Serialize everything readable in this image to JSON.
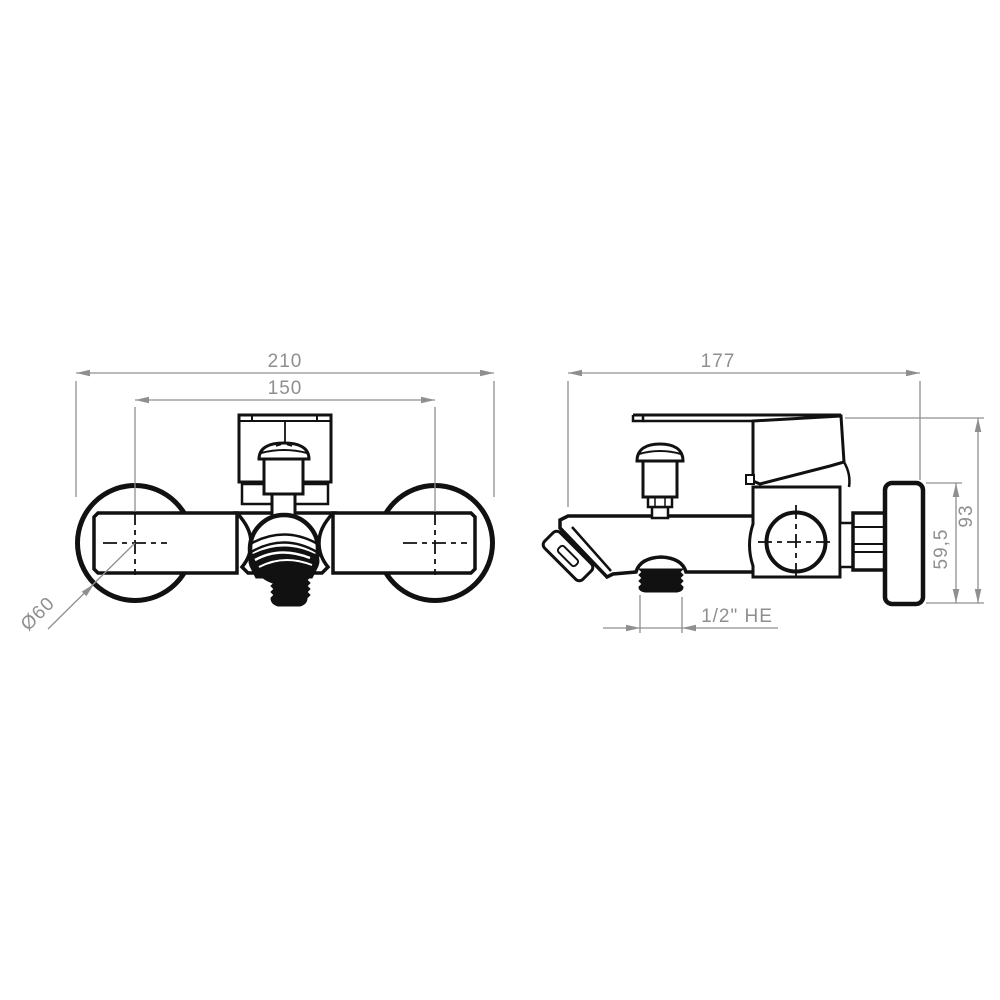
{
  "document": {
    "type": "technical-drawing",
    "subject": "wall-mounted bath shower mixer tap, two orthographic views",
    "background_color": "#ffffff",
    "line_color": "#111111",
    "dimension_color": "#8f8f8f"
  },
  "views": {
    "front": {
      "title": "front-view",
      "dimensions": [
        {
          "label": "210",
          "meaning": "overall width"
        },
        {
          "label": "150",
          "meaning": "distance between flange centers"
        },
        {
          "label": "Ø60",
          "meaning": "flange diameter"
        }
      ]
    },
    "side": {
      "title": "side-view",
      "dimensions": [
        {
          "label": "177",
          "meaning": "overall depth"
        },
        {
          "label": "93",
          "meaning": "overall height"
        },
        {
          "label": "59,5",
          "meaning": "flange height"
        },
        {
          "label": "1/2\" HE",
          "meaning": "threaded outlet size"
        }
      ]
    }
  }
}
